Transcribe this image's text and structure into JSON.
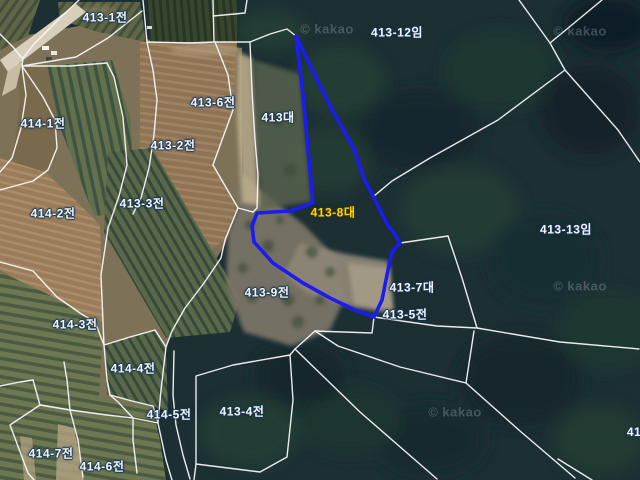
{
  "map": {
    "type": "satellite-cadastral-map",
    "watermark": "© kakao",
    "colors": {
      "boundary_line": "#fafafa",
      "highlight_outline": "#1b1bf2",
      "selected_label": "#ffd400",
      "label": "#f2f6fa"
    },
    "selected_parcel": {
      "id": "413-8",
      "label": "413-8대"
    },
    "labels": [
      {
        "id": "413-1",
        "text": "413-1전"
      },
      {
        "id": "413-12",
        "text": "413-12임"
      },
      {
        "id": "413-6",
        "text": "413-6전"
      },
      {
        "id": "413",
        "text": "413대"
      },
      {
        "id": "414-1",
        "text": "414-1전"
      },
      {
        "id": "413-2",
        "text": "413-2전"
      },
      {
        "id": "414-2",
        "text": "414-2전"
      },
      {
        "id": "413-3",
        "text": "413-3전"
      },
      {
        "id": "413-8",
        "text": "413-8대"
      },
      {
        "id": "413-13",
        "text": "413-13임"
      },
      {
        "id": "413-9",
        "text": "413-9전"
      },
      {
        "id": "413-7",
        "text": "413-7대"
      },
      {
        "id": "413-5",
        "text": "413-5전"
      },
      {
        "id": "414-3",
        "text": "414-3전"
      },
      {
        "id": "414-4",
        "text": "414-4전"
      },
      {
        "id": "414-5",
        "text": "414-5전"
      },
      {
        "id": "413-4",
        "text": "413-4전"
      },
      {
        "id": "414-7",
        "text": "414-7전"
      },
      {
        "id": "414-6",
        "text": "414-6전"
      },
      {
        "id": "41-partial",
        "text": "41"
      }
    ]
  }
}
